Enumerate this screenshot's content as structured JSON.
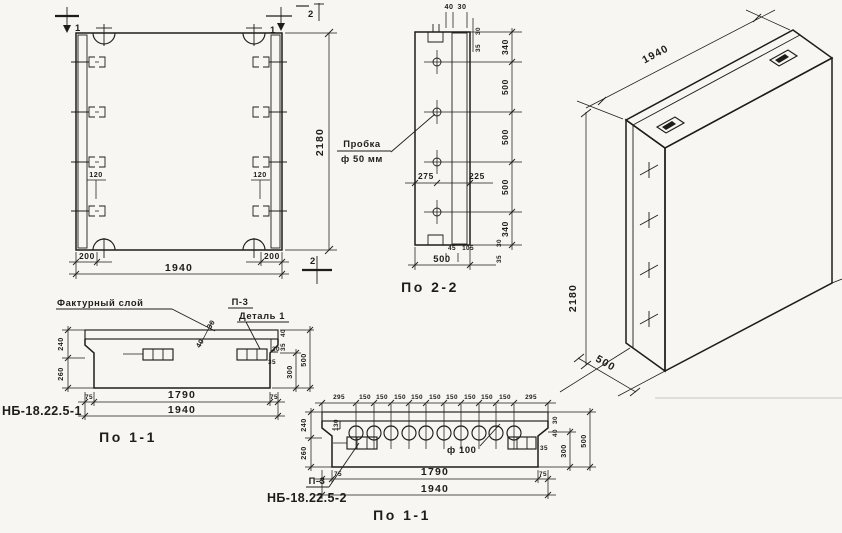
{
  "front": {
    "marker1_left": "1",
    "marker1_right": "1",
    "marker2_top": "2",
    "marker2_bottom": "2",
    "dim_anchor_left": "120",
    "dim_anchor_right": "120",
    "dim_200_left": "200",
    "dim_200_right": "200",
    "dim_total_width": "1940",
    "dim_height": "2180"
  },
  "sec22": {
    "title": "По 2-2",
    "plug_label_line1": "Пробка",
    "plug_label_line2": "ф 50 мм",
    "dim_top_40": "40",
    "dim_top_30": "30",
    "dim_top_rot_35": "35",
    "dim_top_rot_30": "30",
    "chain": [
      "340",
      "500",
      "500",
      "500",
      "340"
    ],
    "dim_mid_275": "275",
    "dim_mid_225": "225",
    "dim_bot_rot_30": "30",
    "dim_bot_rot_35": "35",
    "dim_bot_45": "45",
    "dim_bot_105": "105",
    "dim_bot_total": "500"
  },
  "iso": {
    "dim_length": "1940",
    "dim_height": "2180",
    "dim_depth": "500"
  },
  "s11a": {
    "code": "НБ-18.22.5-1",
    "title": "По 1-1",
    "facing_label": "Фактурный слой",
    "p3_label": "П-3",
    "detail_label": "Деталь 1",
    "dim_diag_40": "40",
    "dim_diag_30": "30",
    "dim_left_240": "240",
    "dim_left_260": "260",
    "dim_r_30": "30",
    "dim_r_35": "35",
    "dim_r_rot_40": "40",
    "dim_r_rot_35": "35",
    "dim_r_300": "300",
    "dim_r_500": "500",
    "dim_b_75l": "75",
    "dim_b_1790": "1790",
    "dim_b_75r": "75",
    "dim_b_total": "1940"
  },
  "s11b": {
    "code": "НБ-18.22.5-2",
    "title": "По 1-1",
    "p3_label": "П-3",
    "hole_label": "ф 100",
    "top_dims": [
      "295",
      "150",
      "150",
      "150",
      "150",
      "150",
      "150",
      "150",
      "150",
      "150",
      "295"
    ],
    "dim_l_130": "130",
    "dim_left_240": "240",
    "dim_left_260": "260",
    "dim_r_35": "35",
    "dim_r_rot_30": "30",
    "dim_r_rot_40": "40",
    "dim_r_300": "300",
    "dim_r_500": "500",
    "dim_b_75l": "75",
    "dim_b_1790": "1790",
    "dim_b_75r": "75",
    "dim_b_total": "1940"
  }
}
